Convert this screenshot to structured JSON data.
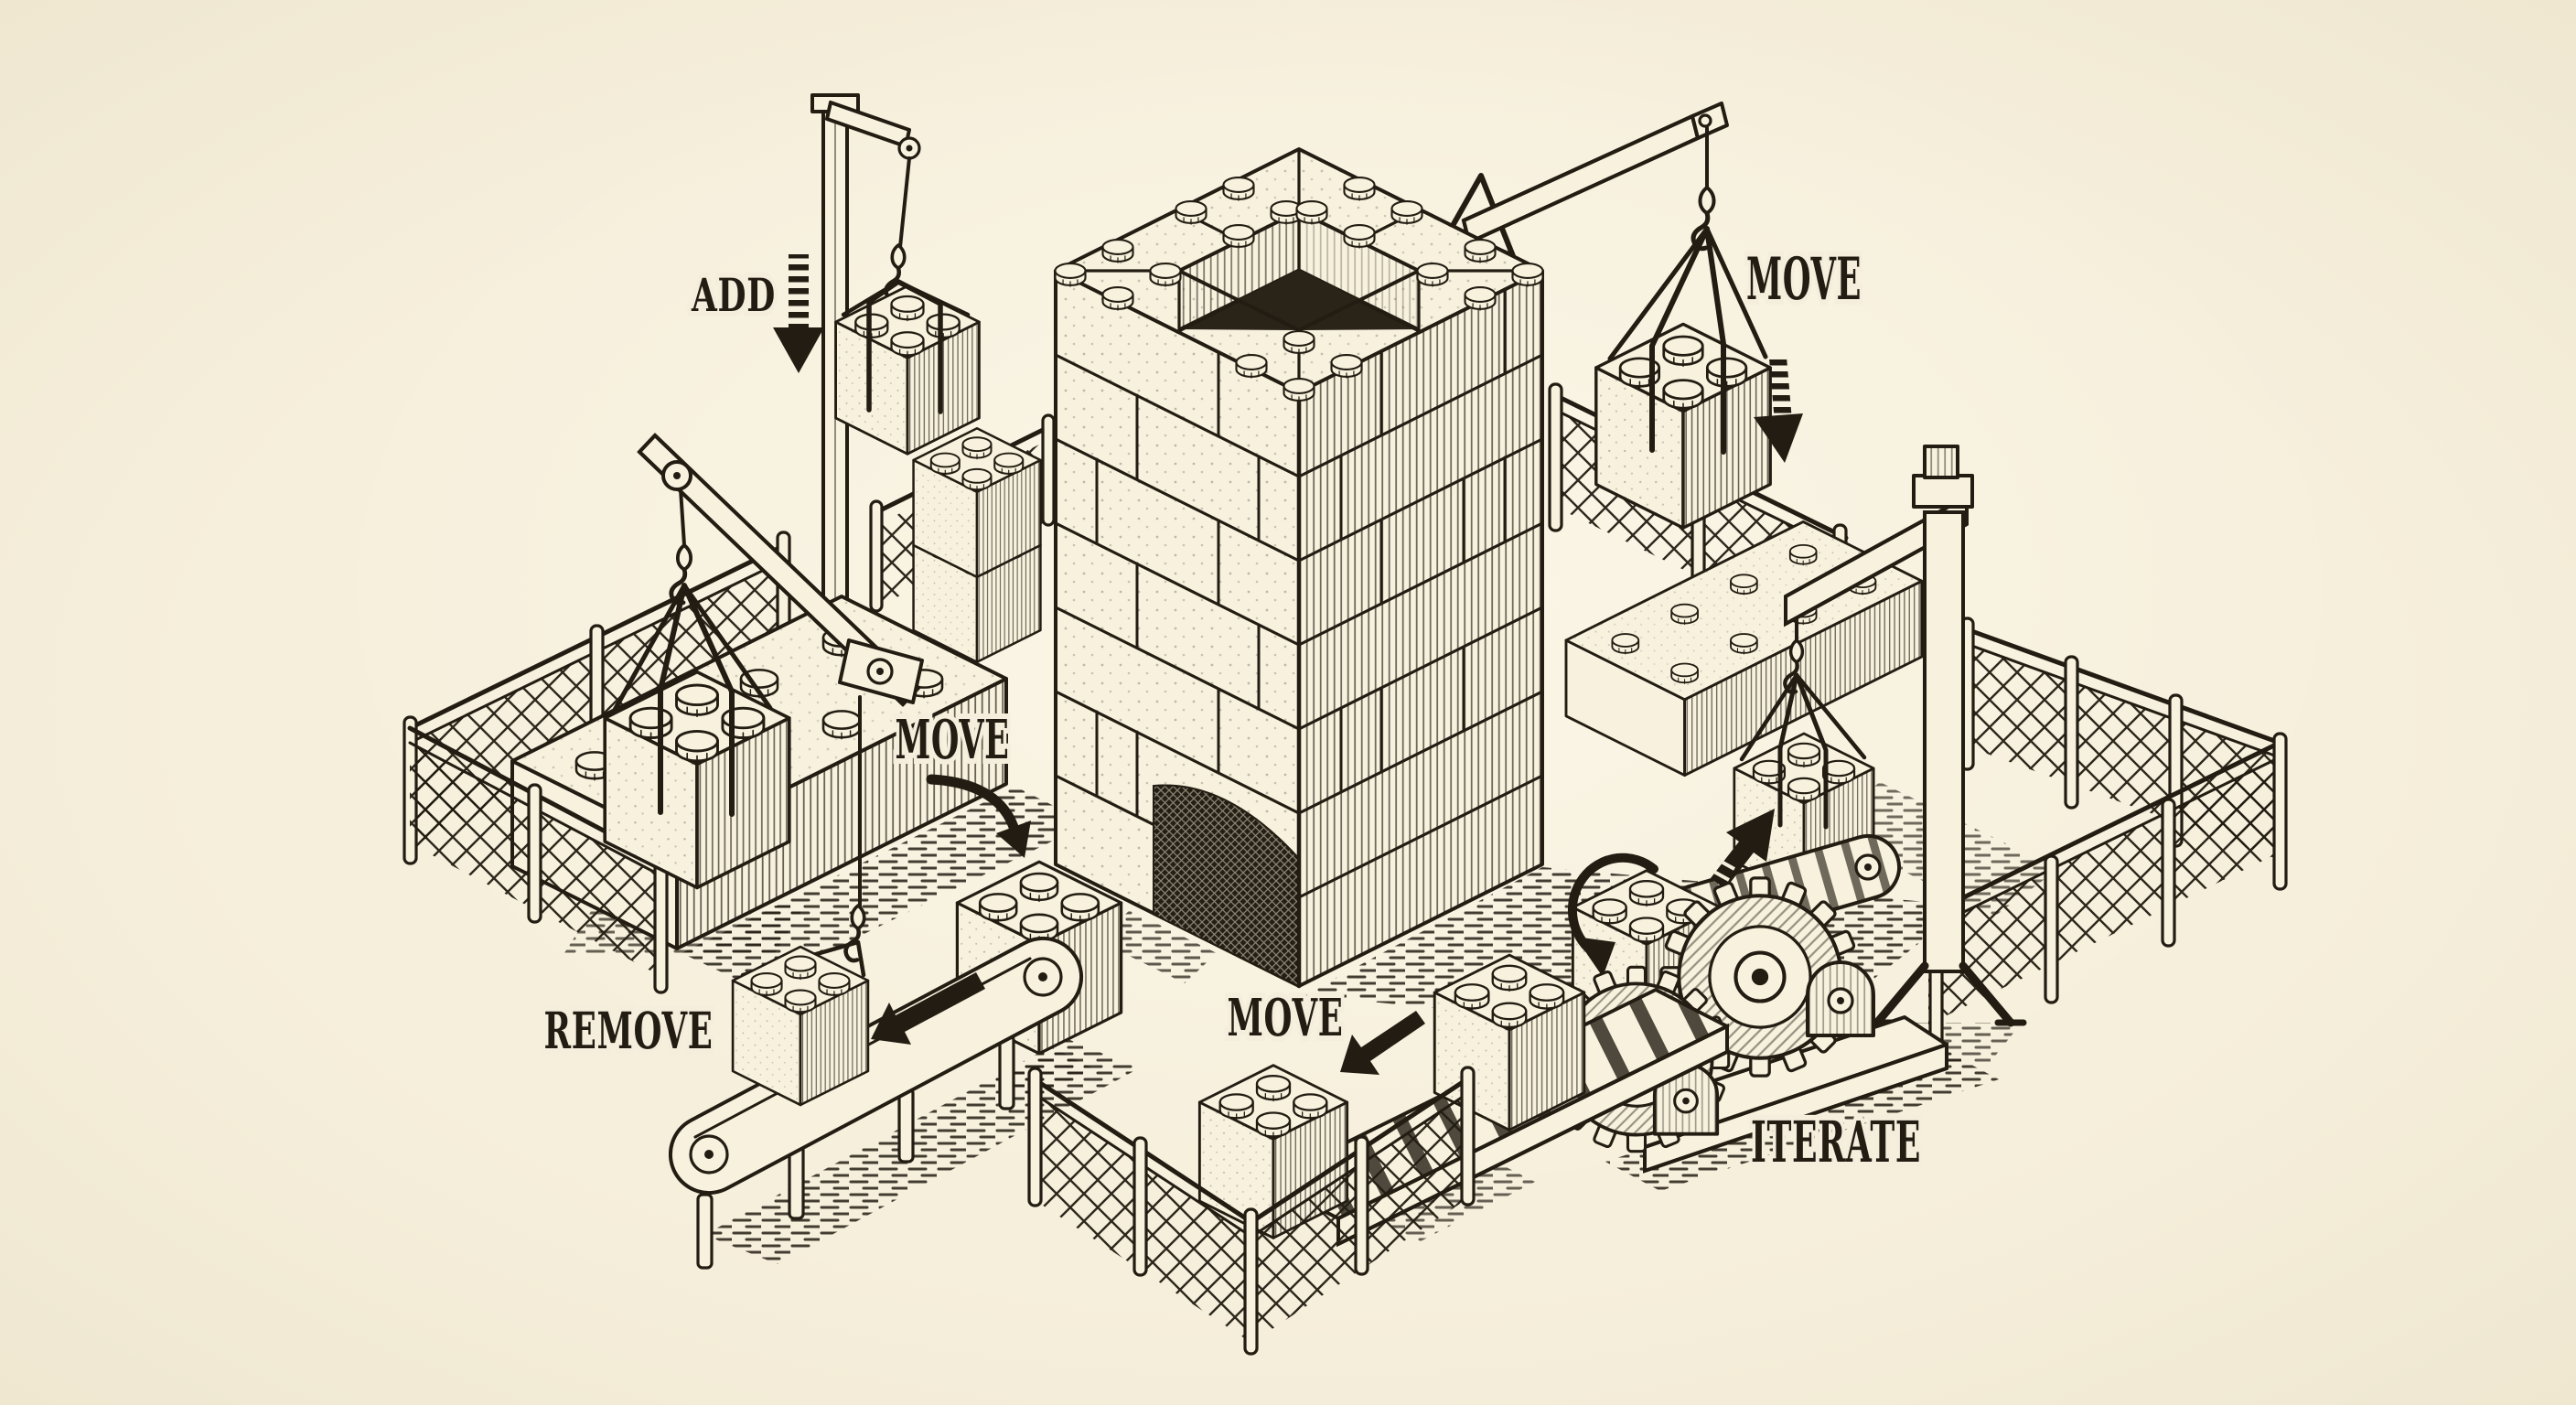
{
  "illustration": {
    "style": "vintage woodcut engraving of an isometric toy-brick construction site",
    "colors": {
      "paper": "#f5eedb",
      "ink": "#221c12"
    },
    "labels": {
      "add": "ADD",
      "move_upper_right": "MOVE",
      "move_center": "MOVE",
      "move_lower": "MOVE",
      "remove": "REMOVE",
      "iterate": "ITERATE"
    }
  }
}
